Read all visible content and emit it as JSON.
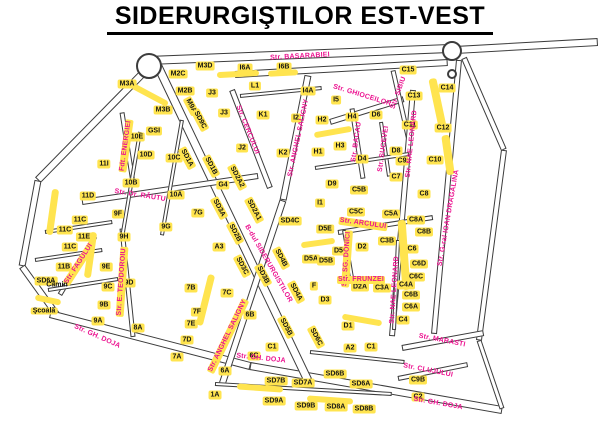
{
  "title": "SIDERURGIŞTILOR EST-VEST",
  "colors": {
    "street_label": "#ec1390",
    "building_fill": "#ffe44f",
    "road_outline": "#3c3c3c",
    "text": "#000000"
  },
  "roundabouts": [
    {
      "x": 149,
      "y": 66,
      "r": 13
    },
    {
      "x": 452,
      "y": 51,
      "r": 10
    },
    {
      "x": 452,
      "y": 74,
      "r": 5
    }
  ],
  "roads": [
    {
      "x1": 148,
      "y1": 60,
      "x2": 450,
      "y2": 48,
      "w": 9
    },
    {
      "x1": 235,
      "y1": 74,
      "x2": 448,
      "y2": 62,
      "w": 7
    },
    {
      "x1": 455,
      "y1": 50,
      "x2": 598,
      "y2": 42,
      "w": 8
    },
    {
      "x1": 150,
      "y1": 66,
      "x2": 38,
      "y2": 180,
      "w": 8
    },
    {
      "x1": 38,
      "y1": 180,
      "x2": 22,
      "y2": 266,
      "w": 7
    },
    {
      "x1": 22,
      "y1": 266,
      "x2": 58,
      "y2": 316,
      "w": 7
    },
    {
      "x1": 50,
      "y1": 314,
      "x2": 250,
      "y2": 366,
      "w": 8
    },
    {
      "x1": 250,
      "y1": 366,
      "x2": 502,
      "y2": 410,
      "w": 8
    },
    {
      "x1": 158,
      "y1": 66,
      "x2": 308,
      "y2": 380,
      "w": 9
    },
    {
      "x1": 308,
      "y1": 75,
      "x2": 283,
      "y2": 200,
      "w": 7
    },
    {
      "x1": 283,
      "y1": 200,
      "x2": 222,
      "y2": 384,
      "w": 7
    },
    {
      "x1": 232,
      "y1": 90,
      "x2": 270,
      "y2": 188,
      "w": 6
    },
    {
      "x1": 122,
      "y1": 112,
      "x2": 133,
      "y2": 182,
      "w": 5
    },
    {
      "x1": 95,
      "y1": 236,
      "x2": 60,
      "y2": 294,
      "w": 5
    },
    {
      "x1": 122,
      "y1": 228,
      "x2": 133,
      "y2": 336,
      "w": 5
    },
    {
      "x1": 82,
      "y1": 202,
      "x2": 258,
      "y2": 176,
      "w": 6
    },
    {
      "x1": 45,
      "y1": 232,
      "x2": 112,
      "y2": 222,
      "w": 4
    },
    {
      "x1": 35,
      "y1": 260,
      "x2": 102,
      "y2": 250,
      "w": 4
    },
    {
      "x1": 48,
      "y1": 290,
      "x2": 118,
      "y2": 279,
      "w": 4
    },
    {
      "x1": 140,
      "y1": 132,
      "x2": 122,
      "y2": 238,
      "w": 4
    },
    {
      "x1": 182,
      "y1": 120,
      "x2": 162,
      "y2": 235,
      "w": 4
    },
    {
      "x1": 330,
      "y1": 122,
      "x2": 404,
      "y2": 99,
      "w": 6
    },
    {
      "x1": 393,
      "y1": 70,
      "x2": 409,
      "y2": 140,
      "w": 5
    },
    {
      "x1": 352,
      "y1": 108,
      "x2": 363,
      "y2": 178,
      "w": 5
    },
    {
      "x1": 381,
      "y1": 122,
      "x2": 389,
      "y2": 176,
      "w": 4
    },
    {
      "x1": 413,
      "y1": 90,
      "x2": 392,
      "y2": 336,
      "w": 6
    },
    {
      "x1": 459,
      "y1": 60,
      "x2": 434,
      "y2": 334,
      "w": 6
    },
    {
      "x1": 464,
      "y1": 58,
      "x2": 504,
      "y2": 150,
      "w": 6
    },
    {
      "x1": 504,
      "y1": 150,
      "x2": 479,
      "y2": 340,
      "w": 6
    },
    {
      "x1": 402,
      "y1": 348,
      "x2": 484,
      "y2": 333,
      "w": 6
    },
    {
      "x1": 398,
      "y1": 378,
      "x2": 468,
      "y2": 364,
      "w": 5
    },
    {
      "x1": 479,
      "y1": 340,
      "x2": 502,
      "y2": 408,
      "w": 5
    },
    {
      "x1": 338,
      "y1": 232,
      "x2": 433,
      "y2": 217,
      "w": 5
    },
    {
      "x1": 344,
      "y1": 230,
      "x2": 354,
      "y2": 290,
      "w": 4
    },
    {
      "x1": 315,
      "y1": 168,
      "x2": 409,
      "y2": 154,
      "w": 4
    },
    {
      "x1": 240,
      "y1": 96,
      "x2": 322,
      "y2": 88,
      "w": 4
    },
    {
      "x1": 310,
      "y1": 352,
      "x2": 404,
      "y2": 362,
      "w": 4
    },
    {
      "x1": 215,
      "y1": 384,
      "x2": 392,
      "y2": 394,
      "w": 4
    },
    {
      "x1": 398,
      "y1": 240,
      "x2": 394,
      "y2": 330,
      "w": 4
    }
  ],
  "strips": [
    {
      "x": 238,
      "y": 74,
      "w": 42,
      "h": 6,
      "rot": -3
    },
    {
      "x": 283,
      "y": 73,
      "w": 30,
      "h": 6,
      "rot": -3
    },
    {
      "x": 150,
      "y": 95,
      "w": 40,
      "h": 6,
      "rot": 28
    },
    {
      "x": 52,
      "y": 212,
      "w": 7,
      "h": 46,
      "rot": 8
    },
    {
      "x": 90,
      "y": 255,
      "w": 7,
      "h": 46,
      "rot": 8
    },
    {
      "x": 48,
      "y": 300,
      "w": 26,
      "h": 6,
      "rot": 12
    },
    {
      "x": 205,
      "y": 300,
      "w": 7,
      "h": 52,
      "rot": 14
    },
    {
      "x": 438,
      "y": 105,
      "w": 8,
      "h": 55,
      "rot": -12
    },
    {
      "x": 404,
      "y": 255,
      "w": 8,
      "h": 70,
      "rot": -4
    },
    {
      "x": 333,
      "y": 132,
      "w": 38,
      "h": 6,
      "rot": -10
    },
    {
      "x": 260,
      "y": 388,
      "w": 46,
      "h": 6,
      "rot": 4
    },
    {
      "x": 330,
      "y": 400,
      "w": 46,
      "h": 6,
      "rot": 4
    },
    {
      "x": 318,
      "y": 243,
      "w": 34,
      "h": 6,
      "rot": -8
    },
    {
      "x": 362,
      "y": 320,
      "w": 40,
      "h": 6,
      "rot": 10
    },
    {
      "x": 448,
      "y": 155,
      "w": 8,
      "h": 40,
      "rot": -8
    }
  ],
  "streets": [
    {
      "label": "Str. BASARABIEI",
      "x": 300,
      "y": 57,
      "rot": -3,
      "hl": false
    },
    {
      "label": "Str. CERCULUI",
      "x": 247,
      "y": 130,
      "rot": 68,
      "hl": false
    },
    {
      "label": "Str. GHIOCEILOR",
      "x": 362,
      "y": 96,
      "rot": 17,
      "hl": false
    },
    {
      "label": "Str. SIBIU",
      "x": 399,
      "y": 93,
      "rot": -70,
      "hl": false
    },
    {
      "label": "Str. BACAU",
      "x": 357,
      "y": 142,
      "rot": -82,
      "hl": false
    },
    {
      "label": "Str. SUCEVEI",
      "x": 384,
      "y": 149,
      "rot": -82,
      "hl": false
    },
    {
      "label": "Str. NAE LEONARD",
      "x": 412,
      "y": 144,
      "rot": -84,
      "hl": false
    },
    {
      "label": "Str. NAE LEONARD",
      "x": 395,
      "y": 290,
      "rot": -86,
      "hl": false
    },
    {
      "label": "Str. G-ral IOAN DRAGALINA",
      "x": 449,
      "y": 218,
      "rot": -80,
      "hl": false
    },
    {
      "label": "Str. Dr. RĂUTU",
      "x": 140,
      "y": 196,
      "rot": 9,
      "hl": false
    },
    {
      "label": "Fdt. ENERGIEI",
      "x": 126,
      "y": 146,
      "rot": -82,
      "hl": true
    },
    {
      "label": "Str. FAGULUI",
      "x": 79,
      "y": 264,
      "rot": -57,
      "hl": true
    },
    {
      "label": "Str. E. TEODOROIU",
      "x": 122,
      "y": 282,
      "rot": -86,
      "hl": true
    },
    {
      "label": "B-dul SIDERURGISTILOR",
      "x": 268,
      "y": 264,
      "rot": 60,
      "hl": false
    },
    {
      "label": "Str. ANGHEL SALIGNY",
      "x": 299,
      "y": 138,
      "rot": -78,
      "hl": false
    },
    {
      "label": "Str. ANGHEL SALIGNY",
      "x": 228,
      "y": 336,
      "rot": -64,
      "hl": true
    },
    {
      "label": "Str. ARCULUI",
      "x": 363,
      "y": 224,
      "rot": 8,
      "hl": true
    },
    {
      "label": "Str. SG. DONICI",
      "x": 347,
      "y": 259,
      "rot": -86,
      "hl": true
    },
    {
      "label": "Str. FRUNZEI",
      "x": 361,
      "y": 280,
      "rot": 0,
      "hl": true
    },
    {
      "label": "Str. GH. DOJA",
      "x": 97,
      "y": 337,
      "rot": 24,
      "hl": false
    },
    {
      "label": "Str. GH. DOJA",
      "x": 261,
      "y": 359,
      "rot": 6,
      "hl": false
    },
    {
      "label": "Str. GH. DOJA",
      "x": 438,
      "y": 404,
      "rot": 10,
      "hl": false
    },
    {
      "label": "Str. MARASTI",
      "x": 442,
      "y": 341,
      "rot": 11,
      "hl": false
    },
    {
      "label": "Str. CLUJULUI",
      "x": 428,
      "y": 371,
      "rot": 11,
      "hl": false
    }
  ],
  "buildings": [
    {
      "label": "M3A",
      "x": 127,
      "y": 84,
      "rot": 0
    },
    {
      "label": "M2C",
      "x": 178,
      "y": 74,
      "rot": 0
    },
    {
      "label": "M3D",
      "x": 205,
      "y": 66,
      "rot": 0
    },
    {
      "label": "M2B",
      "x": 185,
      "y": 91,
      "rot": 0
    },
    {
      "label": "M3B",
      "x": 163,
      "y": 110,
      "rot": 0
    },
    {
      "label": "J3",
      "x": 212,
      "y": 93,
      "rot": 0
    },
    {
      "label": "J3",
      "x": 224,
      "y": 113,
      "rot": 0
    },
    {
      "label": "I6A",
      "x": 245,
      "y": 68,
      "rot": 0
    },
    {
      "label": "I6B",
      "x": 284,
      "y": 67,
      "rot": 0
    },
    {
      "label": "L1",
      "x": 255,
      "y": 86,
      "rot": 0
    },
    {
      "label": "I4A",
      "x": 308,
      "y": 91,
      "rot": 0
    },
    {
      "label": "K1",
      "x": 263,
      "y": 115,
      "rot": 0
    },
    {
      "label": "I2",
      "x": 296,
      "y": 118,
      "rot": 0
    },
    {
      "label": "J2",
      "x": 242,
      "y": 148,
      "rot": 0
    },
    {
      "label": "K2",
      "x": 283,
      "y": 153,
      "rot": 0
    },
    {
      "label": "I5",
      "x": 336,
      "y": 100,
      "rot": 0
    },
    {
      "label": "H2",
      "x": 322,
      "y": 120,
      "rot": 0
    },
    {
      "label": "H4",
      "x": 352,
      "y": 117,
      "rot": 0
    },
    {
      "label": "D6",
      "x": 376,
      "y": 115,
      "rot": 0
    },
    {
      "label": "H3",
      "x": 340,
      "y": 146,
      "rot": 0
    },
    {
      "label": "H1",
      "x": 318,
      "y": 152,
      "rot": 0
    },
    {
      "label": "D4",
      "x": 362,
      "y": 159,
      "rot": 0
    },
    {
      "label": "D8",
      "x": 396,
      "y": 151,
      "rot": 0
    },
    {
      "label": "C9",
      "x": 402,
      "y": 161,
      "rot": 0
    },
    {
      "label": "C7",
      "x": 396,
      "y": 177,
      "rot": 0
    },
    {
      "label": "C15",
      "x": 408,
      "y": 70,
      "rot": 0
    },
    {
      "label": "C13",
      "x": 414,
      "y": 96,
      "rot": 0
    },
    {
      "label": "C14",
      "x": 447,
      "y": 88,
      "rot": 0
    },
    {
      "label": "C11",
      "x": 410,
      "y": 125,
      "rot": 0
    },
    {
      "label": "C12",
      "x": 443,
      "y": 128,
      "rot": 0
    },
    {
      "label": "C10",
      "x": 435,
      "y": 160,
      "rot": 0
    },
    {
      "label": "11I",
      "x": 104,
      "y": 164,
      "rot": 0
    },
    {
      "label": "10E",
      "x": 137,
      "y": 137,
      "rot": 0
    },
    {
      "label": "GSI",
      "x": 154,
      "y": 131,
      "rot": 0
    },
    {
      "label": "10D",
      "x": 146,
      "y": 155,
      "rot": 0
    },
    {
      "label": "10C",
      "x": 174,
      "y": 158,
      "rot": 0
    },
    {
      "label": "10B",
      "x": 131,
      "y": 183,
      "rot": 0
    },
    {
      "label": "10A",
      "x": 176,
      "y": 195,
      "rot": 0
    },
    {
      "label": "11D",
      "x": 88,
      "y": 196,
      "rot": 0
    },
    {
      "label": "9F",
      "x": 118,
      "y": 214,
      "rot": 0
    },
    {
      "label": "7G",
      "x": 198,
      "y": 213,
      "rot": 0
    },
    {
      "label": "11C",
      "x": 80,
      "y": 220,
      "rot": 0
    },
    {
      "label": "11C",
      "x": 65,
      "y": 230,
      "rot": 0
    },
    {
      "label": "11E",
      "x": 84,
      "y": 237,
      "rot": 0
    },
    {
      "label": "9G",
      "x": 166,
      "y": 227,
      "rot": 0
    },
    {
      "label": "9H",
      "x": 124,
      "y": 237,
      "rot": 0
    },
    {
      "label": "11C",
      "x": 70,
      "y": 247,
      "rot": 0
    },
    {
      "label": "11B",
      "x": 64,
      "y": 267,
      "rot": 0
    },
    {
      "label": "9E",
      "x": 106,
      "y": 267,
      "rot": 0
    },
    {
      "label": "9C",
      "x": 108,
      "y": 287,
      "rot": 0
    },
    {
      "label": "9D",
      "x": 129,
      "y": 283,
      "rot": 0
    },
    {
      "label": "9B",
      "x": 104,
      "y": 305,
      "rot": 0
    },
    {
      "label": "9A",
      "x": 98,
      "y": 321,
      "rot": 0
    },
    {
      "label": "8A",
      "x": 138,
      "y": 328,
      "rot": 0
    },
    {
      "label": "G4",
      "x": 223,
      "y": 185,
      "rot": 0
    },
    {
      "label": "D9",
      "x": 332,
      "y": 184,
      "rot": 0
    },
    {
      "label": "I1",
      "x": 320,
      "y": 203,
      "rot": 0
    },
    {
      "label": "C5B",
      "x": 359,
      "y": 190,
      "rot": 0
    },
    {
      "label": "C5C",
      "x": 356,
      "y": 212,
      "rot": 0
    },
    {
      "label": "C5A",
      "x": 391,
      "y": 214,
      "rot": 0
    },
    {
      "label": "C8",
      "x": 424,
      "y": 194,
      "rot": 0
    },
    {
      "label": "C8A",
      "x": 416,
      "y": 220,
      "rot": 0
    },
    {
      "label": "C8B",
      "x": 424,
      "y": 232,
      "rot": 0
    },
    {
      "label": "SD4C",
      "x": 290,
      "y": 221,
      "rot": 0
    },
    {
      "label": "A3",
      "x": 219,
      "y": 247,
      "rot": 0
    },
    {
      "label": "D5E",
      "x": 325,
      "y": 229,
      "rot": 0
    },
    {
      "label": "D5A",
      "x": 311,
      "y": 259,
      "rot": 0
    },
    {
      "label": "D5B",
      "x": 326,
      "y": 261,
      "rot": 0
    },
    {
      "label": "D5C",
      "x": 341,
      "y": 251,
      "rot": 0
    },
    {
      "label": "D2",
      "x": 362,
      "y": 247,
      "rot": 0
    },
    {
      "label": "C3B",
      "x": 387,
      "y": 241,
      "rot": 0
    },
    {
      "label": "C6",
      "x": 412,
      "y": 249,
      "rot": 0
    },
    {
      "label": "C6D",
      "x": 419,
      "y": 264,
      "rot": 0
    },
    {
      "label": "C6C",
      "x": 416,
      "y": 277,
      "rot": 0
    },
    {
      "label": "C4A",
      "x": 406,
      "y": 285,
      "rot": 0
    },
    {
      "label": "C6B",
      "x": 411,
      "y": 295,
      "rot": 0
    },
    {
      "label": "C6A",
      "x": 411,
      "y": 307,
      "rot": 0
    },
    {
      "label": "C4",
      "x": 403,
      "y": 320,
      "rot": 0
    },
    {
      "label": "D2A",
      "x": 360,
      "y": 287,
      "rot": 0
    },
    {
      "label": "C3A",
      "x": 382,
      "y": 288,
      "rot": 0
    },
    {
      "label": "F",
      "x": 314,
      "y": 286,
      "rot": 0
    },
    {
      "label": "D3",
      "x": 325,
      "y": 300,
      "rot": 0
    },
    {
      "label": "D1",
      "x": 348,
      "y": 326,
      "rot": 0
    },
    {
      "label": "A2",
      "x": 350,
      "y": 348,
      "rot": 0
    },
    {
      "label": "C1",
      "x": 371,
      "y": 347,
      "rot": 0
    },
    {
      "label": "7B",
      "x": 191,
      "y": 288,
      "rot": 0
    },
    {
      "label": "7C",
      "x": 227,
      "y": 293,
      "rot": 0
    },
    {
      "label": "7F",
      "x": 197,
      "y": 312,
      "rot": 0
    },
    {
      "label": "7E",
      "x": 191,
      "y": 324,
      "rot": 0
    },
    {
      "label": "7D",
      "x": 187,
      "y": 340,
      "rot": 0
    },
    {
      "label": "7A",
      "x": 177,
      "y": 357,
      "rot": 0
    },
    {
      "label": "6B",
      "x": 250,
      "y": 315,
      "rot": 0
    },
    {
      "label": "6C",
      "x": 254,
      "y": 356,
      "rot": 0
    },
    {
      "label": "6A",
      "x": 225,
      "y": 371,
      "rot": 0
    },
    {
      "label": "C1",
      "x": 272,
      "y": 347,
      "rot": 0
    },
    {
      "label": "1A",
      "x": 215,
      "y": 395,
      "rot": 0
    },
    {
      "label": "C9B",
      "x": 418,
      "y": 380,
      "rot": 0
    },
    {
      "label": "C2",
      "x": 418,
      "y": 397,
      "rot": 0
    },
    {
      "label": "SD7B",
      "x": 276,
      "y": 381,
      "rot": 0
    },
    {
      "label": "SD7A",
      "x": 303,
      "y": 383,
      "rot": 0
    },
    {
      "label": "SD9A",
      "x": 274,
      "y": 401,
      "rot": 0
    },
    {
      "label": "SD9B",
      "x": 306,
      "y": 406,
      "rot": 0
    },
    {
      "label": "SD8A",
      "x": 336,
      "y": 407,
      "rot": 0
    },
    {
      "label": "SD8B",
      "x": 364,
      "y": 409,
      "rot": 0
    },
    {
      "label": "SD6B",
      "x": 335,
      "y": 374,
      "rot": 0
    },
    {
      "label": "SD6A",
      "x": 361,
      "y": 384,
      "rot": 0
    },
    {
      "label": "SD6A",
      "x": 46,
      "y": 281,
      "rot": 0
    },
    {
      "label": "M9A",
      "x": 191,
      "y": 106,
      "rot": 62
    },
    {
      "label": "SD9C",
      "x": 200,
      "y": 120,
      "rot": 62
    },
    {
      "label": "SD1A",
      "x": 187,
      "y": 158,
      "rot": 62
    },
    {
      "label": "SD1B",
      "x": 211,
      "y": 166,
      "rot": 62
    },
    {
      "label": "SD2A2",
      "x": 237,
      "y": 177,
      "rot": 62
    },
    {
      "label": "SD3A",
      "x": 219,
      "y": 208,
      "rot": 62
    },
    {
      "label": "SD2A1",
      "x": 254,
      "y": 210,
      "rot": 62
    },
    {
      "label": "SD2B",
      "x": 235,
      "y": 233,
      "rot": 62
    },
    {
      "label": "SD3C",
      "x": 242,
      "y": 266,
      "rot": 62
    },
    {
      "label": "SD3B",
      "x": 263,
      "y": 275,
      "rot": 62
    },
    {
      "label": "SD4B",
      "x": 281,
      "y": 258,
      "rot": 62
    },
    {
      "label": "SD4A",
      "x": 296,
      "y": 292,
      "rot": 62
    },
    {
      "label": "SD5B",
      "x": 286,
      "y": 327,
      "rot": 62
    },
    {
      "label": "SD6C",
      "x": 316,
      "y": 337,
      "rot": 62
    }
  ],
  "places": [
    {
      "label": "Cămin",
      "x": 57,
      "y": 285,
      "hl": false
    },
    {
      "label": "Şcoală",
      "x": 44,
      "y": 311,
      "hl": true
    }
  ]
}
